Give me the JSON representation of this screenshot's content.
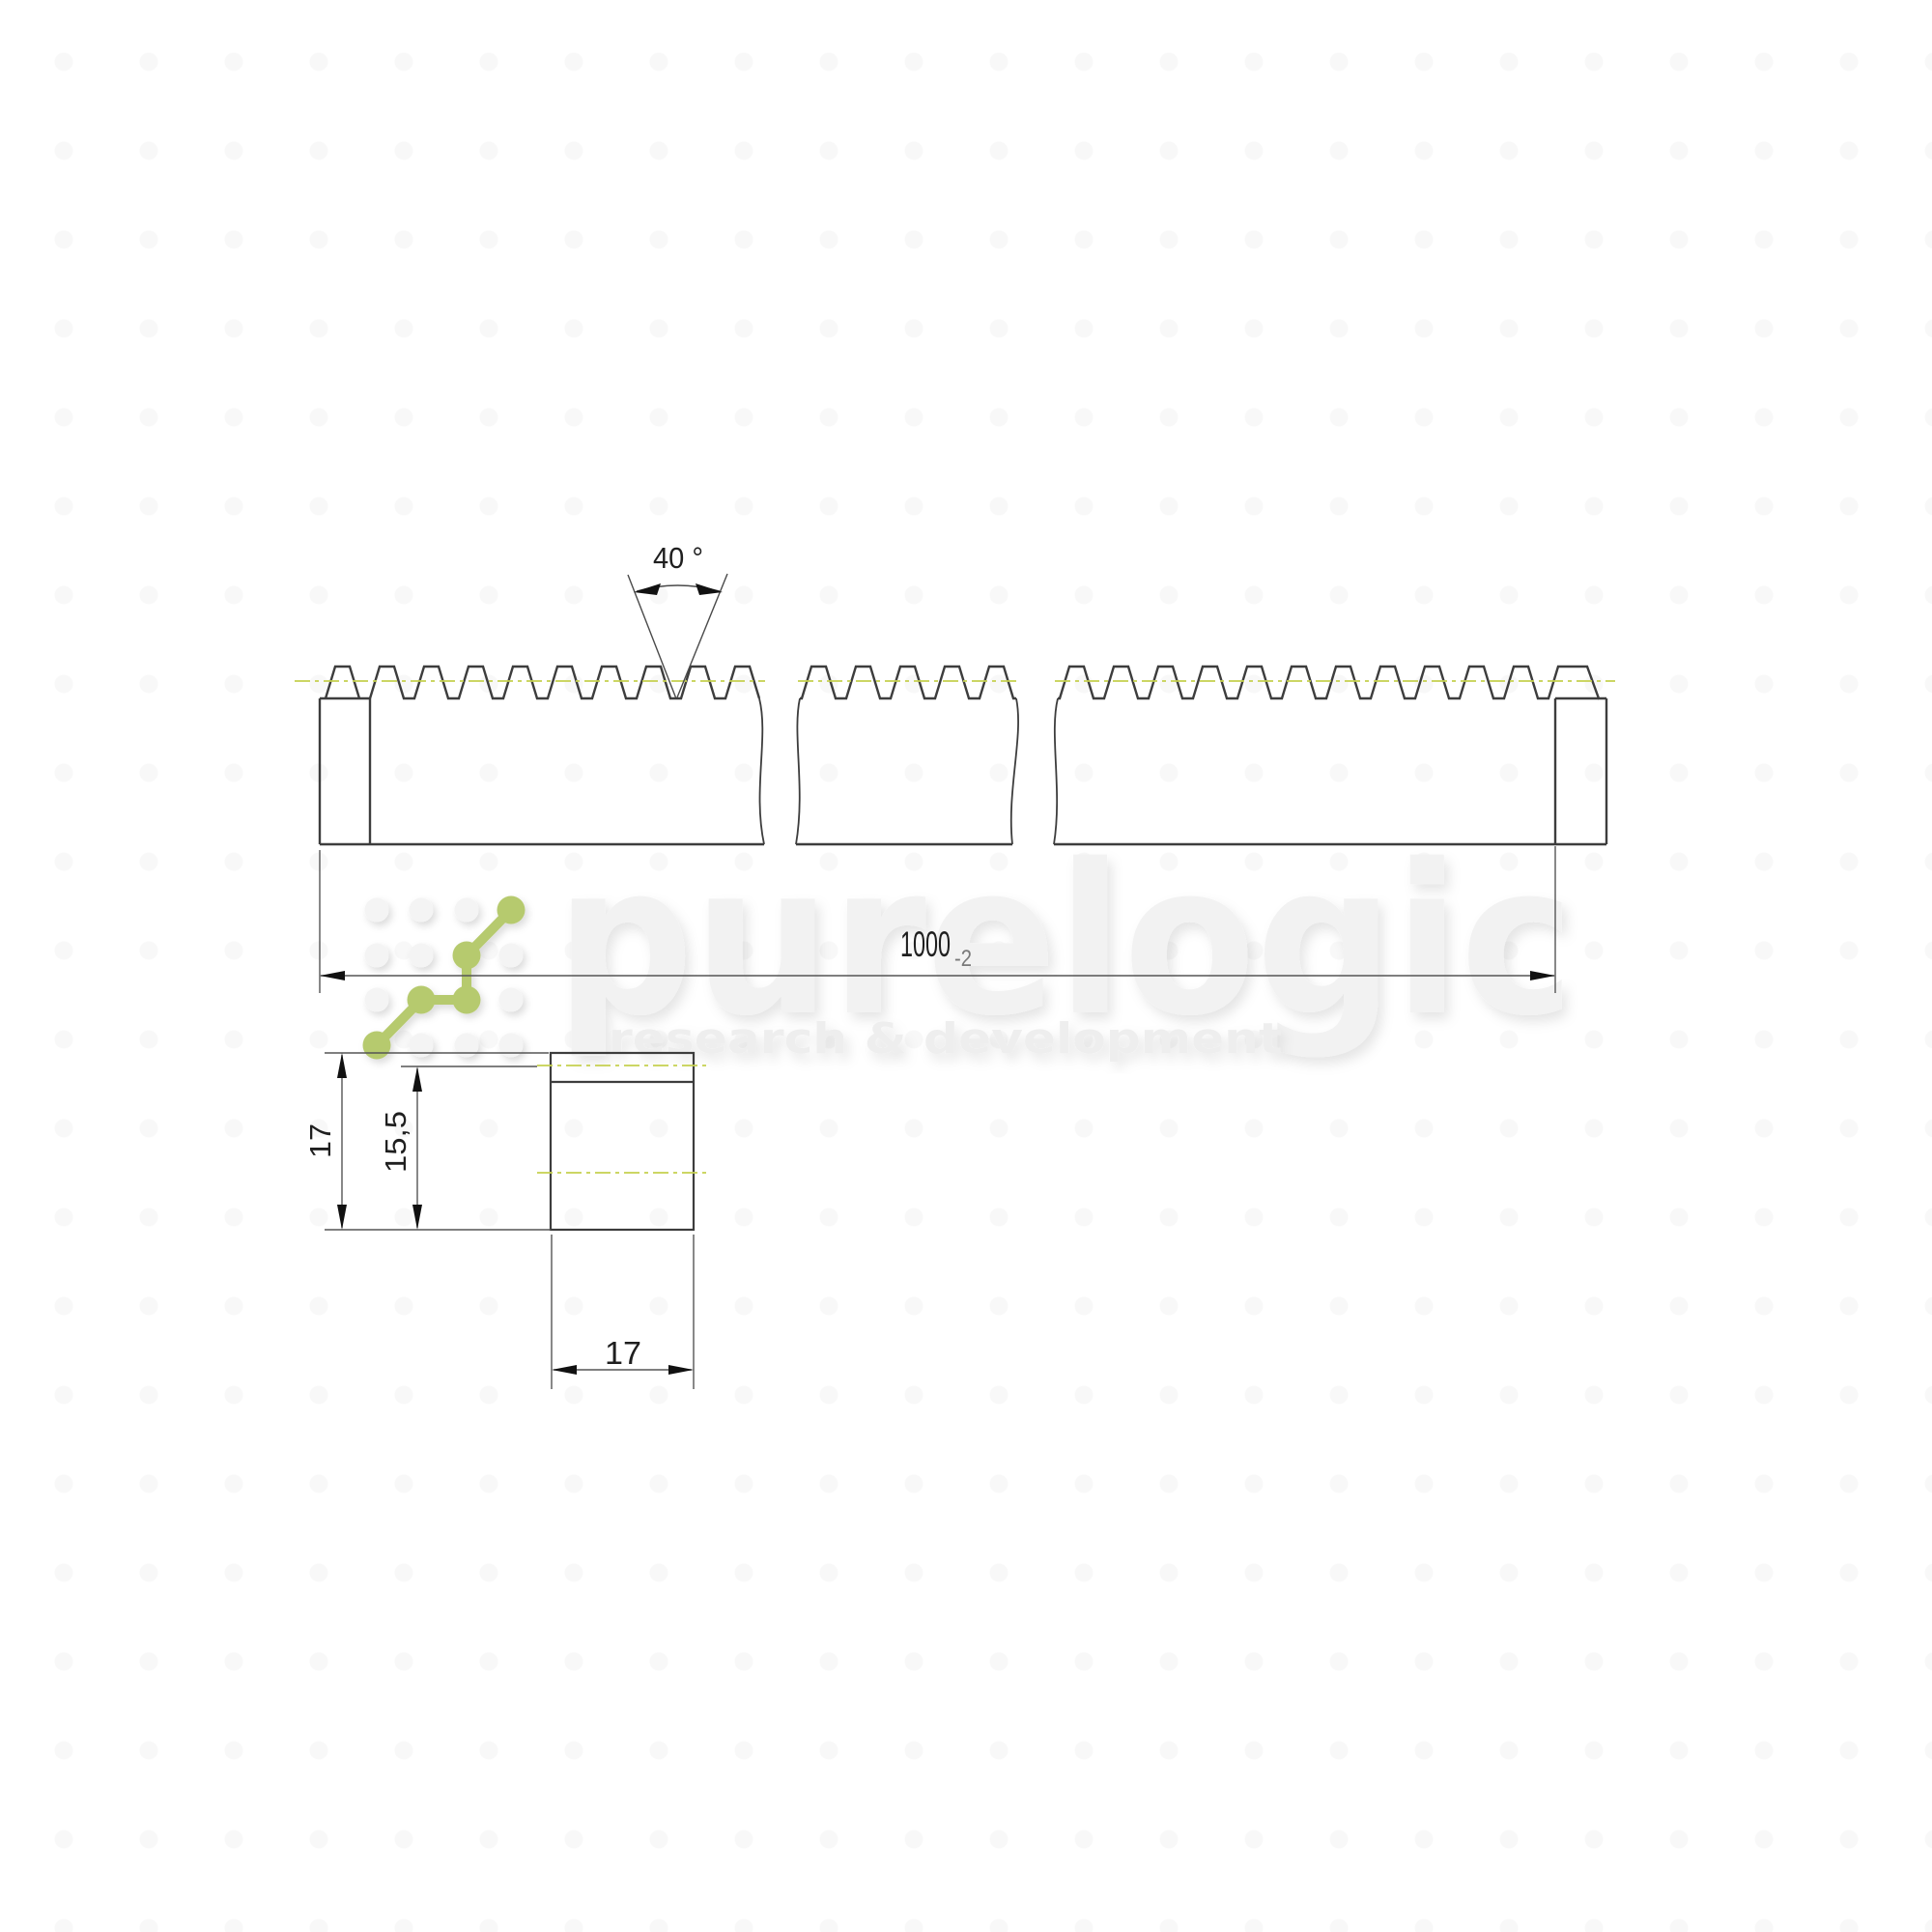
{
  "watermark": {
    "brand": "purelogic",
    "tagline": "research & development",
    "logo_icon": "dot-grid-zigzag-logo",
    "accent_color": "#b6ca6e"
  },
  "drawing": {
    "type": "gear-rack-technical-drawing",
    "line_color": "#3d3d3d",
    "pitch_line_color": "#c5d04f",
    "dimensions": {
      "tooth_angle": "40 °",
      "length_value": "1000",
      "length_tolerance": "-2",
      "total_height": "17",
      "pitch_height": "15,5",
      "width": "17"
    }
  }
}
